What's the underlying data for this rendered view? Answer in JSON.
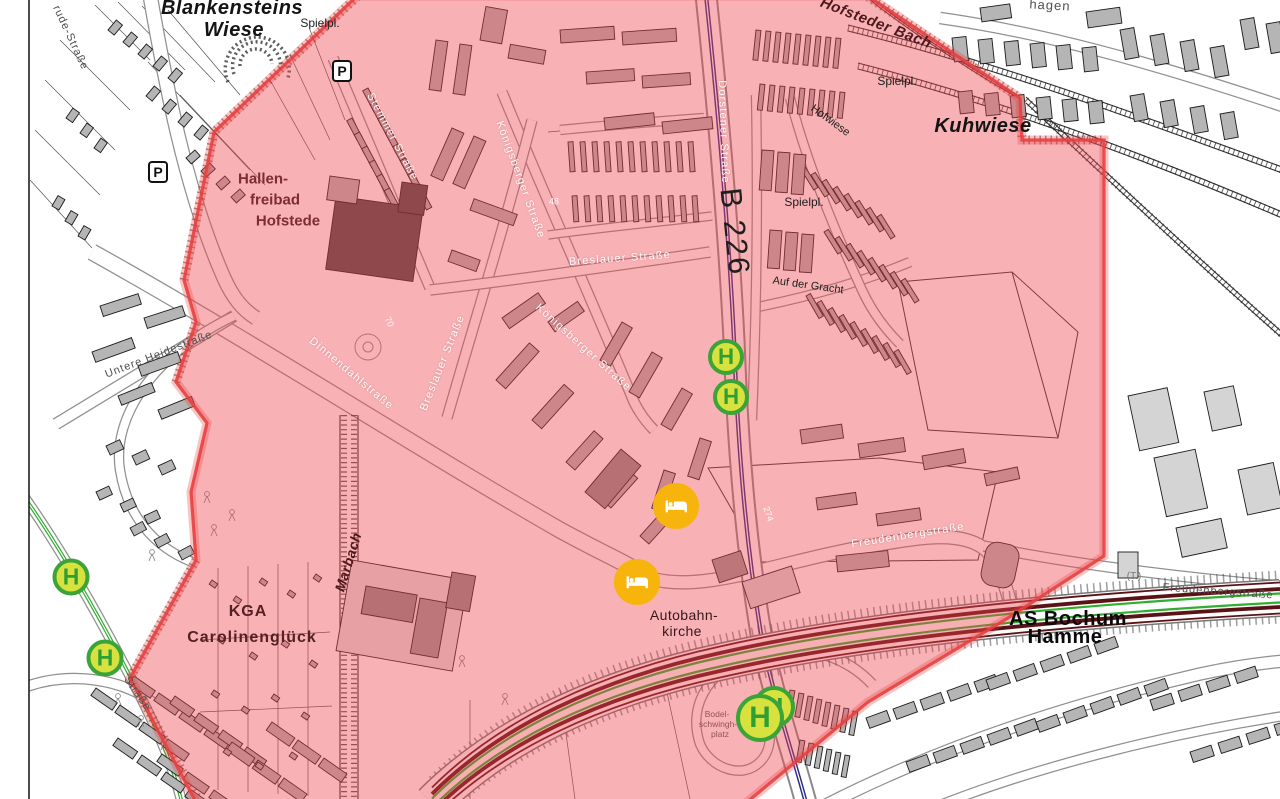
{
  "map": {
    "title": "Evakuierungszone Bochum Hofstede",
    "colors": {
      "zone_fill": "#EF444E",
      "zone_border": "#E84040",
      "bus_stop_ring": "#3BA438",
      "bus_stop_fill": "#D8E23F",
      "bus_stop_letter": "#2F9E33",
      "hotel_fill": "#F6B40C",
      "motorway_green": "#2FAE2F",
      "b226_line": "#2B2B85",
      "building_gray": "#B5B5B5"
    },
    "markers": {
      "bus_stop_glyph": "H",
      "parking_glyph": "P",
      "hotel_icon": "bed-icon",
      "bus_stops": [
        {
          "x": 726,
          "y": 357,
          "d": 36
        },
        {
          "x": 731,
          "y": 397,
          "d": 36
        },
        {
          "x": 71,
          "y": 577,
          "d": 37
        },
        {
          "x": 105,
          "y": 658,
          "d": 37
        },
        {
          "x": 774,
          "y": 707,
          "d": 42
        },
        {
          "x": 760,
          "y": 718,
          "d": 48
        }
      ],
      "hotels": [
        {
          "x": 676,
          "y": 506,
          "d": 46
        },
        {
          "x": 637,
          "y": 582,
          "d": 46
        }
      ],
      "parking": [
        {
          "x": 158,
          "y": 172
        },
        {
          "x": 342,
          "y": 71
        }
      ]
    },
    "labels": [
      {
        "id": "blankensteins-wiese-1",
        "text": "Blankensteins",
        "x": 232,
        "y": 8,
        "rot": 0,
        "size": 20,
        "style": "area"
      },
      {
        "id": "blankensteins-wiese-2",
        "text": "Wiese",
        "x": 234,
        "y": 30,
        "rot": 0,
        "size": 20,
        "style": "area"
      },
      {
        "id": "spielplatz-nw",
        "text": "Spielpl.",
        "x": 320,
        "y": 23,
        "rot": 0,
        "size": 12,
        "style": "small"
      },
      {
        "id": "hofsteder-bach",
        "text": "Hofsteder Bach",
        "x": 876,
        "y": 23,
        "rot": 21,
        "size": 15,
        "style": "stream"
      },
      {
        "id": "spielplatz-ne",
        "text": "Spielpl.",
        "x": 897,
        "y": 81,
        "rot": 0,
        "size": 12,
        "style": "small"
      },
      {
        "id": "kuhwiese",
        "text": "Kuhwiese",
        "x": 983,
        "y": 126,
        "rot": 0,
        "size": 20,
        "style": "area"
      },
      {
        "id": "hofwiese",
        "text": "Hofwiese",
        "x": 830,
        "y": 121,
        "rot": 36,
        "size": 11,
        "style": "small"
      },
      {
        "id": "spielplatz-e",
        "text": "Spielpl.",
        "x": 804,
        "y": 202,
        "rot": 0,
        "size": 12,
        "style": "small"
      },
      {
        "id": "auf-der-gracht",
        "text": "Auf der Gracht",
        "x": 808,
        "y": 286,
        "rot": 8,
        "size": 11,
        "style": "small"
      },
      {
        "id": "b226",
        "text": "B 226",
        "x": 734,
        "y": 232,
        "rot": 84,
        "size": 30,
        "style": "route"
      },
      {
        "id": "dorstener-strasse",
        "text": "Dorstener Straße",
        "x": 723,
        "y": 132,
        "rot": 88,
        "size": 11,
        "style": "street-light"
      },
      {
        "id": "stemmer-strasse",
        "text": "Stemmer Straße",
        "x": 392,
        "y": 137,
        "rot": 62,
        "size": 11,
        "style": "street-light"
      },
      {
        "id": "koenigsberger-strasse-n",
        "text": "Königsberger Straße",
        "x": 520,
        "y": 180,
        "rot": 70,
        "size": 11,
        "style": "street-light"
      },
      {
        "id": "koenigsberger-strasse-s",
        "text": "Königsberger Straße",
        "x": 583,
        "y": 348,
        "rot": 42,
        "size": 11,
        "style": "street-light"
      },
      {
        "id": "breslauer-strasse-diag",
        "text": "Breslauer Straße",
        "x": 443,
        "y": 363,
        "rot": -68,
        "size": 11,
        "style": "street-light"
      },
      {
        "id": "breslauer-strasse",
        "text": "Breslauer Straße",
        "x": 620,
        "y": 259,
        "rot": -4,
        "size": 11,
        "style": "street-light"
      },
      {
        "id": "dinnendahlstrasse",
        "text": "Dinnendahlstraße",
        "x": 351,
        "y": 374,
        "rot": 40,
        "size": 11,
        "style": "street-light"
      },
      {
        "id": "untere-heidestrasse",
        "text": "Untere Heidestraße",
        "x": 159,
        "y": 355,
        "rot": -21,
        "size": 11,
        "style": "street-dark"
      },
      {
        "id": "hallenfreibad-1",
        "text": "Hallen-",
        "x": 263,
        "y": 179,
        "rot": 0,
        "size": 15,
        "style": "poi"
      },
      {
        "id": "hallenfreibad-2",
        "text": "freibad",
        "x": 275,
        "y": 200,
        "rot": 0,
        "size": 15,
        "style": "poi"
      },
      {
        "id": "hallenfreibad-3",
        "text": "Hofstede",
        "x": 288,
        "y": 221,
        "rot": 0,
        "size": 15,
        "style": "poi"
      },
      {
        "id": "marbach",
        "text": "Marbach",
        "x": 348,
        "y": 562,
        "rot": -73,
        "size": 14,
        "style": "stream"
      },
      {
        "id": "kga-1",
        "text": "KGA",
        "x": 248,
        "y": 612,
        "rot": 0,
        "size": 16,
        "style": "poi2"
      },
      {
        "id": "kga-2",
        "text": "Carolinenglück",
        "x": 252,
        "y": 638,
        "rot": 0,
        "size": 16,
        "style": "poi2"
      },
      {
        "id": "autobahnkirche-1",
        "text": "Autobahn-",
        "x": 684,
        "y": 615,
        "rot": 0,
        "size": 14,
        "style": "small-dark"
      },
      {
        "id": "autobahnkirche-2",
        "text": "kirche",
        "x": 682,
        "y": 631,
        "rot": 0,
        "size": 14,
        "style": "small-dark"
      },
      {
        "id": "as-bochum-hamme-1",
        "text": "AS Bochum",
        "x": 1068,
        "y": 619,
        "rot": 0,
        "size": 20,
        "style": "bold"
      },
      {
        "id": "as-bochum-hamme-2",
        "text": "Hamme",
        "x": 1065,
        "y": 637,
        "rot": 0,
        "size": 20,
        "style": "bold"
      },
      {
        "id": "freudenbergstrasse",
        "text": "Freudenbergstraße",
        "x": 908,
        "y": 536,
        "rot": -9,
        "size": 11,
        "style": "street-light"
      },
      {
        "id": "freudenbergstrasse-e",
        "text": "Freudenbergstraße",
        "x": 1218,
        "y": 592,
        "rot": 4,
        "size": 11,
        "style": "street-dark"
      },
      {
        "id": "bodelschwingh-1",
        "text": "Bodel-",
        "x": 717,
        "y": 714,
        "rot": 0,
        "size": 8.5,
        "style": "tiny"
      },
      {
        "id": "bodelschwingh-2",
        "text": "schwingh-",
        "x": 718,
        "y": 724,
        "rot": 0,
        "size": 8.5,
        "style": "tiny"
      },
      {
        "id": "bodelschwingh-3",
        "text": "platz",
        "x": 720,
        "y": 734,
        "rot": 0,
        "size": 8.5,
        "style": "tiny"
      },
      {
        "id": "gertrude-strasse",
        "text": "rude-Straße",
        "x": 70,
        "y": 38,
        "rot": 65,
        "size": 11,
        "style": "street-dark"
      },
      {
        "id": "strasse-sw",
        "text": "Straße",
        "x": 137,
        "y": 694,
        "rot": 55,
        "size": 11,
        "style": "street-dark"
      },
      {
        "id": "hagen",
        "text": "hagen",
        "x": 1050,
        "y": 5,
        "rot": 3,
        "size": 13,
        "style": "street-dark"
      },
      {
        "id": "t-label",
        "text": "(T.)",
        "x": 1134,
        "y": 577,
        "rot": 0,
        "size": 10,
        "style": "tiny2"
      },
      {
        "id": "hnum-48",
        "text": "48",
        "x": 554,
        "y": 202,
        "rot": 0,
        "size": 9,
        "style": "num"
      },
      {
        "id": "hnum-70",
        "text": "70",
        "x": 389,
        "y": 322,
        "rot": 65,
        "size": 9,
        "style": "num"
      },
      {
        "id": "hnum-274",
        "text": "274",
        "x": 768,
        "y": 514,
        "rot": 70,
        "size": 9,
        "style": "num"
      }
    ]
  }
}
